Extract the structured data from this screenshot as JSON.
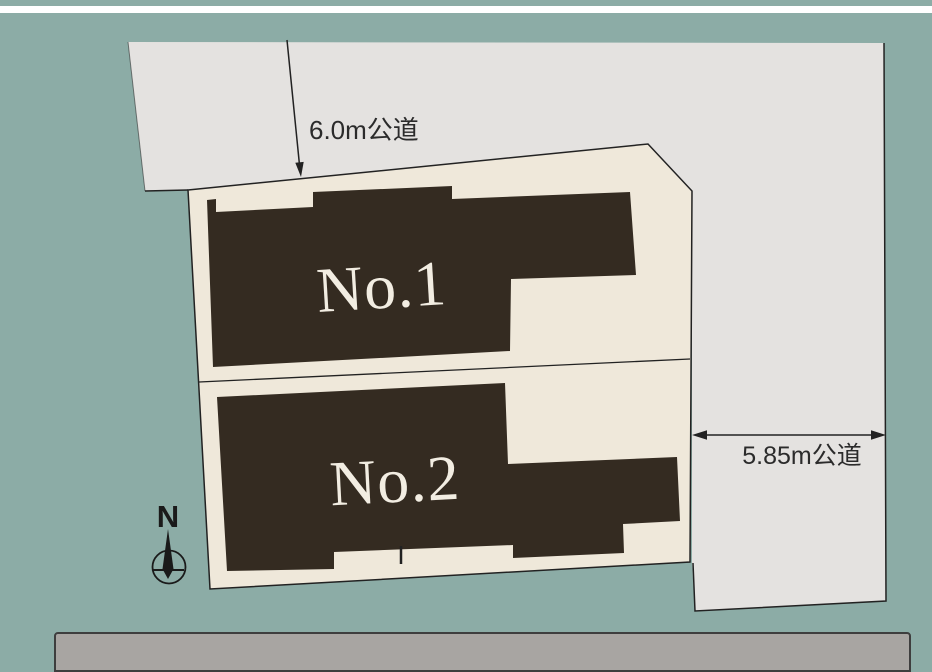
{
  "plan": {
    "road_top_label": "6.0m公道",
    "road_right_label": "5.85m公道",
    "lot1_label": "No.1",
    "lot2_label": "No.2",
    "north_label": "N"
  },
  "colors": {
    "background_teal": "#8CACA6",
    "road_gray": "#E4E2E0",
    "lot_cream": "#EFE8DA",
    "building_dark": "#342B21",
    "line_dark": "#222222",
    "label_cream": "#F2EDE2",
    "dim_text": "#2B2B2B",
    "panel_gray": "#A8A5A2",
    "panel_border": "#3E3E3E",
    "top_bar_white": "#FFFFFF"
  }
}
